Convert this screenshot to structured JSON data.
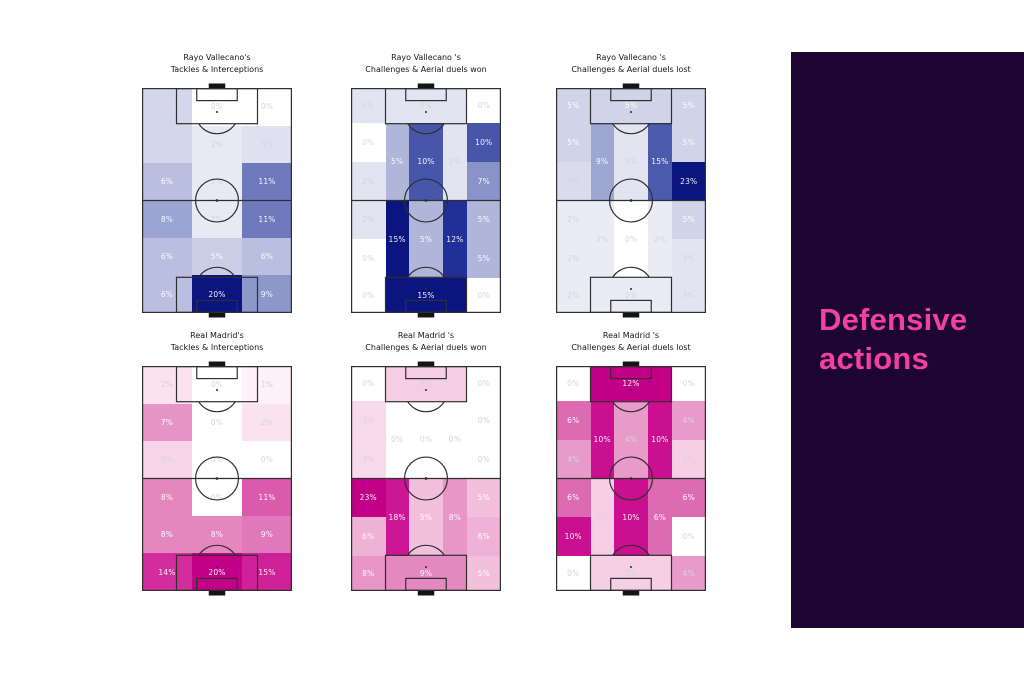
{
  "sidebar": {
    "title": "Defensive actions",
    "bg_color": "#1d0533",
    "text_color": "#f2419b",
    "x": 791,
    "y": 52,
    "width": 233,
    "height": 576
  },
  "palettes": {
    "blue": [
      [
        0,
        "#ffffff"
      ],
      [
        0.08,
        "#ebecf6"
      ],
      [
        0.15,
        "#dfe1f0"
      ],
      [
        0.25,
        "#c9cde5"
      ],
      [
        0.35,
        "#aab1d8"
      ],
      [
        0.5,
        "#7f8ac3"
      ],
      [
        0.65,
        "#4d5bac"
      ],
      [
        0.8,
        "#222f97"
      ],
      [
        1,
        "#0a1580"
      ]
    ],
    "pink": [
      [
        0,
        "#ffffff"
      ],
      [
        0.08,
        "#fbe7f2"
      ],
      [
        0.15,
        "#f7d4e8"
      ],
      [
        0.25,
        "#efb6d8"
      ],
      [
        0.35,
        "#e795c6"
      ],
      [
        0.5,
        "#dd6bb2"
      ],
      [
        0.65,
        "#d53ba1"
      ],
      [
        0.8,
        "#cb1292"
      ],
      [
        1,
        "#c20087"
      ]
    ]
  },
  "line_color": "#2f2f2f",
  "goal_color": "#141414",
  "chart_data": [
    {
      "type": "heatmap",
      "title_line1": "Rayo Vallecano's",
      "title_line2": "Tackles & Interceptions",
      "palette": "blue",
      "max": 20,
      "x": 142,
      "y": 52,
      "cells": [
        [
          0,
          0,
          0.3333,
          0.1667,
          4
        ],
        [
          0.3333,
          0,
          0.3334,
          0.1667,
          0
        ],
        [
          0.6667,
          0,
          0.3333,
          0.1667,
          0
        ],
        [
          0,
          0.1667,
          0.3333,
          0.1666,
          4
        ],
        [
          0.3333,
          0.1667,
          0.3334,
          0.1666,
          2
        ],
        [
          0.6667,
          0.1667,
          0.3333,
          0.1666,
          3
        ],
        [
          0,
          0.3333,
          0.3333,
          0.1667,
          6
        ],
        [
          0.3333,
          0.3333,
          0.3334,
          0.1667,
          2
        ],
        [
          0.6667,
          0.3333,
          0.3333,
          0.1667,
          11
        ],
        [
          0,
          0.5,
          0.3333,
          0.1667,
          8
        ],
        [
          0.3333,
          0.5,
          0.3334,
          0.1667,
          2
        ],
        [
          0.6667,
          0.5,
          0.3333,
          0.1667,
          11
        ],
        [
          0,
          0.6667,
          0.3333,
          0.1666,
          6
        ],
        [
          0.3333,
          0.6667,
          0.3334,
          0.1666,
          5
        ],
        [
          0.6667,
          0.6667,
          0.3333,
          0.1666,
          6
        ],
        [
          0,
          0.8333,
          0.3333,
          0.1667,
          6
        ],
        [
          0.3333,
          0.8333,
          0.3334,
          0.1667,
          20
        ],
        [
          0.6667,
          0.8333,
          0.3333,
          0.1667,
          9
        ]
      ]
    },
    {
      "type": "heatmap",
      "title_line1": "Rayo Vallecano 's",
      "title_line2": "Challenges & Aerial duels won",
      "palette": "blue",
      "max": 15,
      "x": 351,
      "y": 52,
      "cells": [
        [
          0,
          0,
          0.23,
          0.157,
          2
        ],
        [
          0.23,
          0,
          0.54,
          0.157,
          2
        ],
        [
          0.77,
          0,
          0.23,
          0.157,
          0
        ],
        [
          0,
          0.157,
          0.23,
          0.173,
          0
        ],
        [
          0,
          0.33,
          0.23,
          0.17,
          2
        ],
        [
          0.23,
          0.157,
          0.155,
          0.343,
          5
        ],
        [
          0.385,
          0.157,
          0.23,
          0.343,
          10
        ],
        [
          0.615,
          0.157,
          0.155,
          0.343,
          2
        ],
        [
          0.77,
          0.157,
          0.23,
          0.173,
          10
        ],
        [
          0.77,
          0.33,
          0.23,
          0.17,
          7
        ],
        [
          0,
          0.5,
          0.23,
          0.17,
          2
        ],
        [
          0,
          0.67,
          0.23,
          0.173,
          0
        ],
        [
          0.23,
          0.5,
          0.155,
          0.343,
          15
        ],
        [
          0.385,
          0.5,
          0.23,
          0.343,
          5
        ],
        [
          0.615,
          0.5,
          0.155,
          0.343,
          12
        ],
        [
          0.77,
          0.5,
          0.23,
          0.17,
          5
        ],
        [
          0.77,
          0.67,
          0.23,
          0.173,
          5
        ],
        [
          0,
          0.843,
          0.23,
          0.157,
          0
        ],
        [
          0.23,
          0.843,
          0.54,
          0.157,
          15
        ],
        [
          0.77,
          0.843,
          0.23,
          0.157,
          0
        ]
      ]
    },
    {
      "type": "heatmap",
      "title_line1": "Rayo Vallecano 's",
      "title_line2": "Challenges & Aerial duels lost",
      "palette": "blue",
      "max": 23,
      "x": 556,
      "y": 52,
      "cells": [
        [
          0,
          0,
          0.23,
          0.157,
          5
        ],
        [
          0.23,
          0,
          0.54,
          0.157,
          5
        ],
        [
          0.77,
          0,
          0.23,
          0.157,
          5
        ],
        [
          0,
          0.157,
          0.23,
          0.173,
          5
        ],
        [
          0,
          0.33,
          0.23,
          0.17,
          4
        ],
        [
          0.23,
          0.157,
          0.155,
          0.343,
          9
        ],
        [
          0.385,
          0.157,
          0.23,
          0.343,
          3
        ],
        [
          0.615,
          0.157,
          0.155,
          0.343,
          15
        ],
        [
          0.77,
          0.157,
          0.23,
          0.173,
          5
        ],
        [
          0.77,
          0.33,
          0.23,
          0.17,
          23
        ],
        [
          0,
          0.5,
          0.23,
          0.17,
          2
        ],
        [
          0,
          0.67,
          0.23,
          0.173,
          2
        ],
        [
          0.23,
          0.5,
          0.155,
          0.343,
          2
        ],
        [
          0.385,
          0.5,
          0.23,
          0.343,
          0
        ],
        [
          0.615,
          0.5,
          0.155,
          0.343,
          2
        ],
        [
          0.77,
          0.5,
          0.23,
          0.17,
          5
        ],
        [
          0.77,
          0.67,
          0.23,
          0.173,
          3
        ],
        [
          0,
          0.843,
          0.23,
          0.157,
          2
        ],
        [
          0.23,
          0.843,
          0.54,
          0.157,
          2
        ],
        [
          0.77,
          0.843,
          0.23,
          0.157,
          3
        ]
      ]
    },
    {
      "type": "heatmap",
      "title_line1": "Real Madrid's",
      "title_line2": "Tackles & Interceptions",
      "palette": "pink",
      "max": 20,
      "x": 142,
      "y": 330,
      "cells": [
        [
          0,
          0,
          0.3333,
          0.1667,
          2
        ],
        [
          0.3333,
          0,
          0.3334,
          0.1667,
          0
        ],
        [
          0.6667,
          0,
          0.3333,
          0.1667,
          1
        ],
        [
          0,
          0.1667,
          0.3333,
          0.1666,
          7
        ],
        [
          0.3333,
          0.1667,
          0.3334,
          0.1666,
          0
        ],
        [
          0.6667,
          0.1667,
          0.3333,
          0.1666,
          2
        ],
        [
          0,
          0.3333,
          0.3333,
          0.1667,
          3
        ],
        [
          0.3333,
          0.3333,
          0.3334,
          0.1667,
          0
        ],
        [
          0.6667,
          0.3333,
          0.3333,
          0.1667,
          0
        ],
        [
          0,
          0.5,
          0.3333,
          0.1667,
          8
        ],
        [
          0.3333,
          0.5,
          0.3334,
          0.1667,
          0
        ],
        [
          0.6667,
          0.5,
          0.3333,
          0.1667,
          11
        ],
        [
          0,
          0.6667,
          0.3333,
          0.1666,
          8
        ],
        [
          0.3333,
          0.6667,
          0.3334,
          0.1666,
          8
        ],
        [
          0.6667,
          0.6667,
          0.3333,
          0.1666,
          9
        ],
        [
          0,
          0.8333,
          0.3333,
          0.1667,
          14
        ],
        [
          0.3333,
          0.8333,
          0.3334,
          0.1667,
          20
        ],
        [
          0.6667,
          0.8333,
          0.3333,
          0.1667,
          15
        ]
      ]
    },
    {
      "type": "heatmap",
      "title_line1": "Real Madrid 's",
      "title_line2": "Challenges & Aerial duels won",
      "palette": "pink",
      "max": 23,
      "x": 351,
      "y": 330,
      "cells": [
        [
          0,
          0,
          0.23,
          0.157,
          0
        ],
        [
          0.23,
          0,
          0.54,
          0.157,
          4
        ],
        [
          0.77,
          0,
          0.23,
          0.157,
          0
        ],
        [
          0,
          0.157,
          0.23,
          0.173,
          3
        ],
        [
          0,
          0.33,
          0.23,
          0.17,
          3
        ],
        [
          0.23,
          0.157,
          0.155,
          0.343,
          0
        ],
        [
          0.385,
          0.157,
          0.23,
          0.343,
          0
        ],
        [
          0.615,
          0.157,
          0.155,
          0.343,
          0
        ],
        [
          0.77,
          0.157,
          0.23,
          0.173,
          0
        ],
        [
          0.77,
          0.33,
          0.23,
          0.17,
          0
        ],
        [
          0,
          0.5,
          0.23,
          0.17,
          23
        ],
        [
          0,
          0.67,
          0.23,
          0.173,
          6
        ],
        [
          0.23,
          0.5,
          0.155,
          0.343,
          18
        ],
        [
          0.385,
          0.5,
          0.23,
          0.343,
          5
        ],
        [
          0.615,
          0.5,
          0.155,
          0.343,
          8
        ],
        [
          0.77,
          0.5,
          0.23,
          0.17,
          5
        ],
        [
          0.77,
          0.67,
          0.23,
          0.173,
          6
        ],
        [
          0,
          0.843,
          0.23,
          0.157,
          8
        ],
        [
          0.23,
          0.843,
          0.54,
          0.157,
          9
        ],
        [
          0.77,
          0.843,
          0.23,
          0.157,
          5
        ]
      ]
    },
    {
      "type": "heatmap",
      "title_line1": "Real Madrid 's",
      "title_line2": "Challenges & Aerial duels lost",
      "palette": "pink",
      "max": 12,
      "x": 556,
      "y": 330,
      "cells": [
        [
          0,
          0,
          0.23,
          0.157,
          0
        ],
        [
          0.23,
          0,
          0.54,
          0.157,
          12
        ],
        [
          0.77,
          0,
          0.23,
          0.157,
          0
        ],
        [
          0,
          0.157,
          0.23,
          0.173,
          6
        ],
        [
          0,
          0.33,
          0.23,
          0.17,
          4
        ],
        [
          0.23,
          0.157,
          0.155,
          0.343,
          10
        ],
        [
          0.385,
          0.157,
          0.23,
          0.343,
          4
        ],
        [
          0.615,
          0.157,
          0.155,
          0.343,
          10
        ],
        [
          0.77,
          0.157,
          0.23,
          0.173,
          4
        ],
        [
          0.77,
          0.33,
          0.23,
          0.17,
          2
        ],
        [
          0,
          0.5,
          0.23,
          0.17,
          6
        ],
        [
          0,
          0.67,
          0.23,
          0.173,
          10
        ],
        [
          0.23,
          0.5,
          0.155,
          0.343,
          2
        ],
        [
          0.385,
          0.5,
          0.23,
          0.343,
          10
        ],
        [
          0.615,
          0.5,
          0.155,
          0.343,
          6
        ],
        [
          0.77,
          0.5,
          0.23,
          0.17,
          6
        ],
        [
          0.77,
          0.67,
          0.23,
          0.173,
          0
        ],
        [
          0,
          0.843,
          0.23,
          0.157,
          0
        ],
        [
          0.23,
          0.843,
          0.54,
          0.157,
          2
        ],
        [
          0.77,
          0.843,
          0.23,
          0.157,
          4
        ]
      ]
    }
  ]
}
